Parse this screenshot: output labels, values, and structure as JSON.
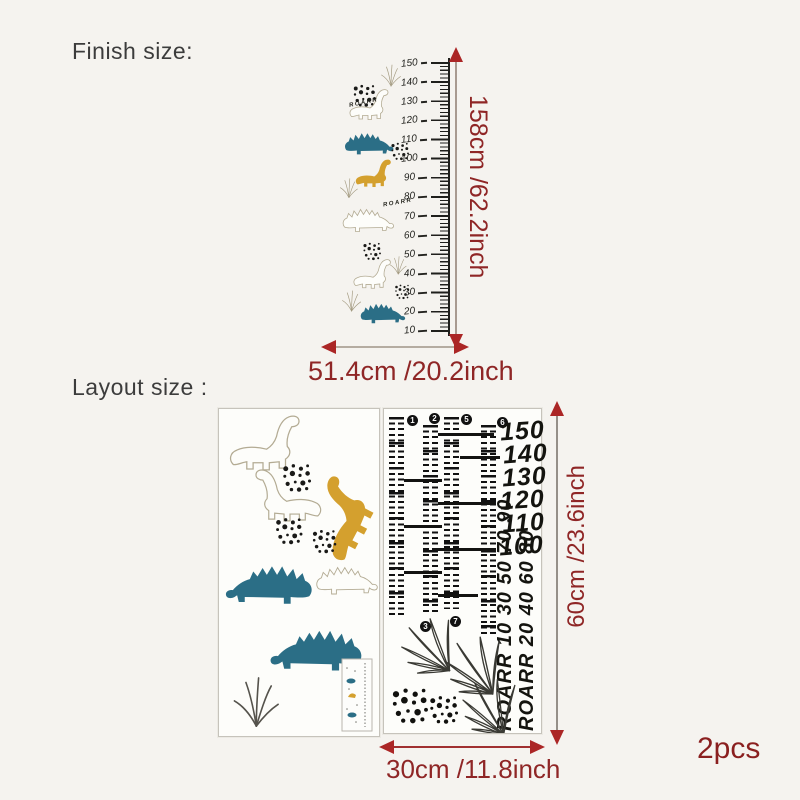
{
  "colors": {
    "background": "#f5f3ef",
    "accent_red": "#8f2626",
    "arrow_red": "#ab2626",
    "teal": "#2b6e86",
    "mustard": "#d4a02e",
    "ink": "#1a1a18",
    "outline_tan": "#b3ab93"
  },
  "finish_section": {
    "label": "Finish size:",
    "height_label": "158cm /62.2inch",
    "width_label": "51.4cm /20.2inch",
    "roarr_text": "ROARR",
    "ruler_numbers": [
      "150",
      "140",
      "130",
      "120",
      "110",
      "100",
      "90",
      "80",
      "70",
      "60",
      "50",
      "40",
      "30",
      "20",
      "10"
    ]
  },
  "layout_section": {
    "label": "Layout size :",
    "height_label": "60cm /23.6inch",
    "width_label": "30cm /11.8inch",
    "pieces_label": "2pcs",
    "right_sheet": {
      "big_numbers": [
        "150",
        "140",
        "130",
        "120",
        "110",
        "100"
      ],
      "rotated_column_a": "ROARR 10 30 50 70 90",
      "rotated_column_b": "ROARR 20 40 60 80",
      "strip_markers_top": [
        "1",
        "2",
        "5",
        "6"
      ],
      "strip_markers_bottom": [
        "3",
        "7"
      ]
    }
  }
}
